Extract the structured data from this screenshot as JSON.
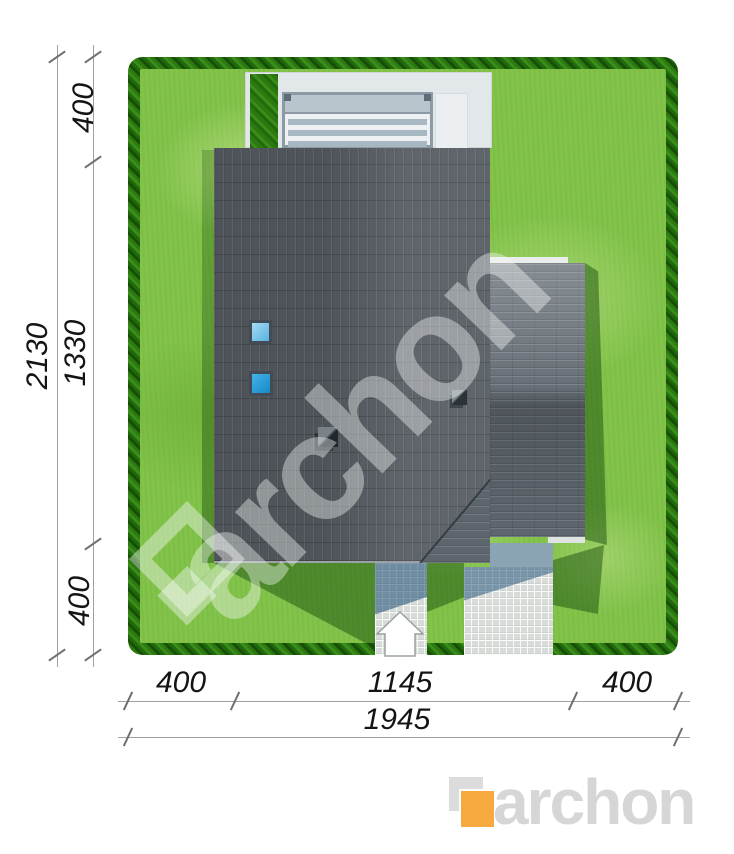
{
  "dimensions": {
    "left": {
      "top_margin": "400",
      "total": "2130",
      "house_depth": "1330",
      "bottom_margin": "400"
    },
    "bottom": {
      "left_margin": "400",
      "house_width": "1145",
      "right_margin": "400",
      "total": "1945"
    }
  },
  "watermark": {
    "text": "archon"
  },
  "brand_logo": {
    "text": "archon",
    "accent_color": "#f6a93e",
    "text_color": "#d6d6d6"
  },
  "colors": {
    "grass": "#82c34a",
    "hedge": "#2a7a10",
    "roof_main": "#575d63",
    "roof_wing": "#656d75",
    "terrace": "#e2e7e9",
    "skylight_upper": "#6fc0e9",
    "skylight_lower": "#2a9fd8",
    "paving_light": "#d8dcd8",
    "paving_shadow": "rgba(25,75,115,0.5)",
    "shadow_green": "rgba(22,76,12,0.48)"
  },
  "icons": {
    "entrance_arrow": "white house-shaped up arrow marking the entrance",
    "watermark_diamond": "rotated square archon logo mark",
    "logo_mark": "overlapping gray and orange squares"
  }
}
